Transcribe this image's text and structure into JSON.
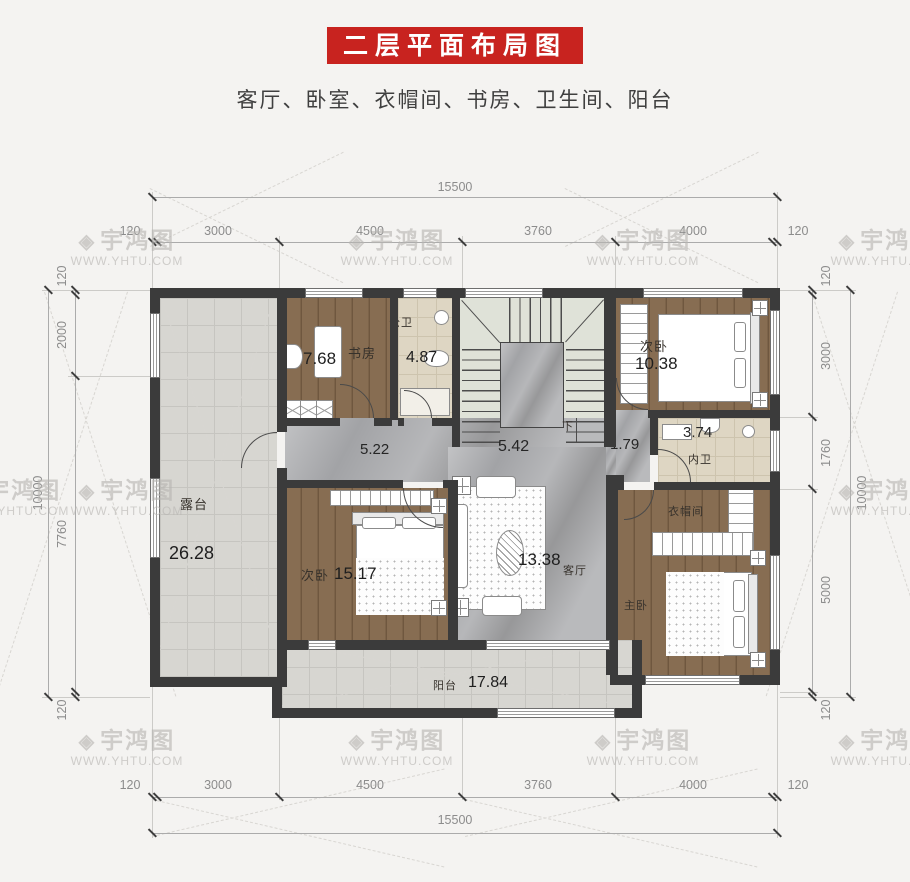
{
  "title": "二层平面布局图",
  "subtitle": "客厅、卧室、衣帽间、书房、卫生间、阳台",
  "watermark": {
    "logo": "◈",
    "brand": "宇鸿图",
    "url": "WWW.YHTU.COM"
  },
  "colors": {
    "accent_red": "#c8231f",
    "wall": "#3b3b3b",
    "wood_floor": "#82684e",
    "tile_floor": "#d7d6d1",
    "marble_floor": "#a2a3a6",
    "bath_floor": "#ded6c3"
  },
  "dims": {
    "top": {
      "overall": "15500",
      "segments": [
        "120",
        "3000",
        "4500",
        "3760",
        "4000",
        "120"
      ]
    },
    "bottom": {
      "overall": "15500",
      "segments": [
        "120",
        "3000",
        "4500",
        "3760",
        "4000",
        "120"
      ]
    },
    "left": {
      "overall": "10000",
      "segments": [
        "120",
        "2000",
        "7760",
        "120"
      ]
    },
    "right": {
      "overall": "10000",
      "segments": [
        "120",
        "3000",
        "1760",
        "5000",
        "120"
      ]
    }
  },
  "rooms": {
    "study": {
      "name": "书房",
      "area": "7.68"
    },
    "public_bath": {
      "name": "公卫",
      "area": "4.87"
    },
    "bedroom_top": {
      "name": "次卧",
      "area": "10.38"
    },
    "hall_left": {
      "area": "5.22"
    },
    "hall_mid": {
      "area": "5.42"
    },
    "hall_right": {
      "area": "1.79"
    },
    "ensuite_bath": {
      "name": "内卫",
      "area": "3.74"
    },
    "terrace": {
      "name": "露台",
      "area": "26.28"
    },
    "bedroom_bot": {
      "name": "次卧",
      "area": "15.17"
    },
    "living": {
      "name": "客厅",
      "area": "13.38"
    },
    "cloakroom": {
      "name": "衣帽间"
    },
    "master": {
      "name": "主卧"
    },
    "balcony": {
      "name": "阳台",
      "area": "17.84"
    }
  },
  "stairs": {
    "down_label": "下"
  }
}
